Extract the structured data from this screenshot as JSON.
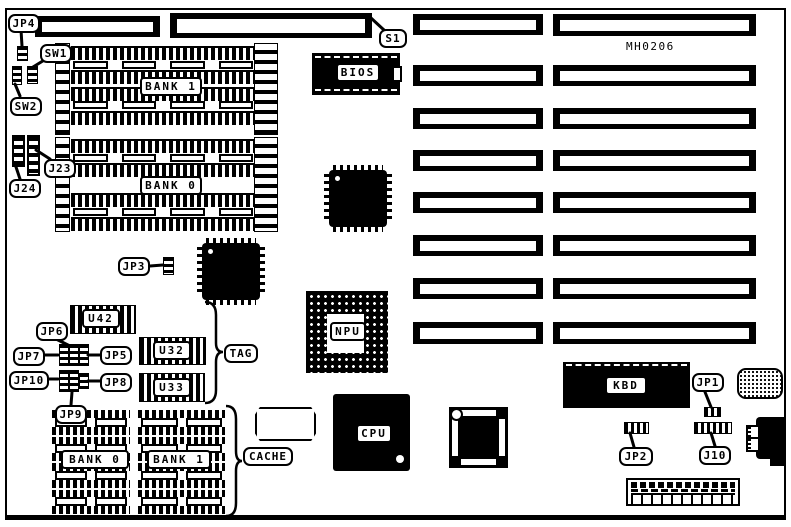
{
  "board": {
    "model_number": "MH0206",
    "memory_banks": {
      "bank1": "BANK 1",
      "bank0": "BANK 0"
    },
    "cache_banks": {
      "bank0": "BANK 0",
      "bank1": "BANK 1",
      "group_label": "CACHE",
      "tag_label": "TAG"
    },
    "chips": {
      "bios": "BIOS",
      "npu": "NPU",
      "cpu": "CPU",
      "kbd": "KBD",
      "u42": "U42",
      "u32": "U32",
      "u33": "U33"
    },
    "jumpers": {
      "jp1": "JP1",
      "jp2": "JP2",
      "jp3": "JP3",
      "jp4": "JP4",
      "jp5": "JP5",
      "jp6": "JP6",
      "jp7": "JP7",
      "jp8": "JP8",
      "jp9": "JP9",
      "jp10": "JP10",
      "j10": "J10",
      "j23": "J23",
      "j24": "J24"
    },
    "switches": {
      "sw1": "SW1",
      "sw2": "SW2",
      "s1": "S1"
    }
  },
  "colors": {
    "line": "#000000",
    "background": "#ffffff"
  }
}
